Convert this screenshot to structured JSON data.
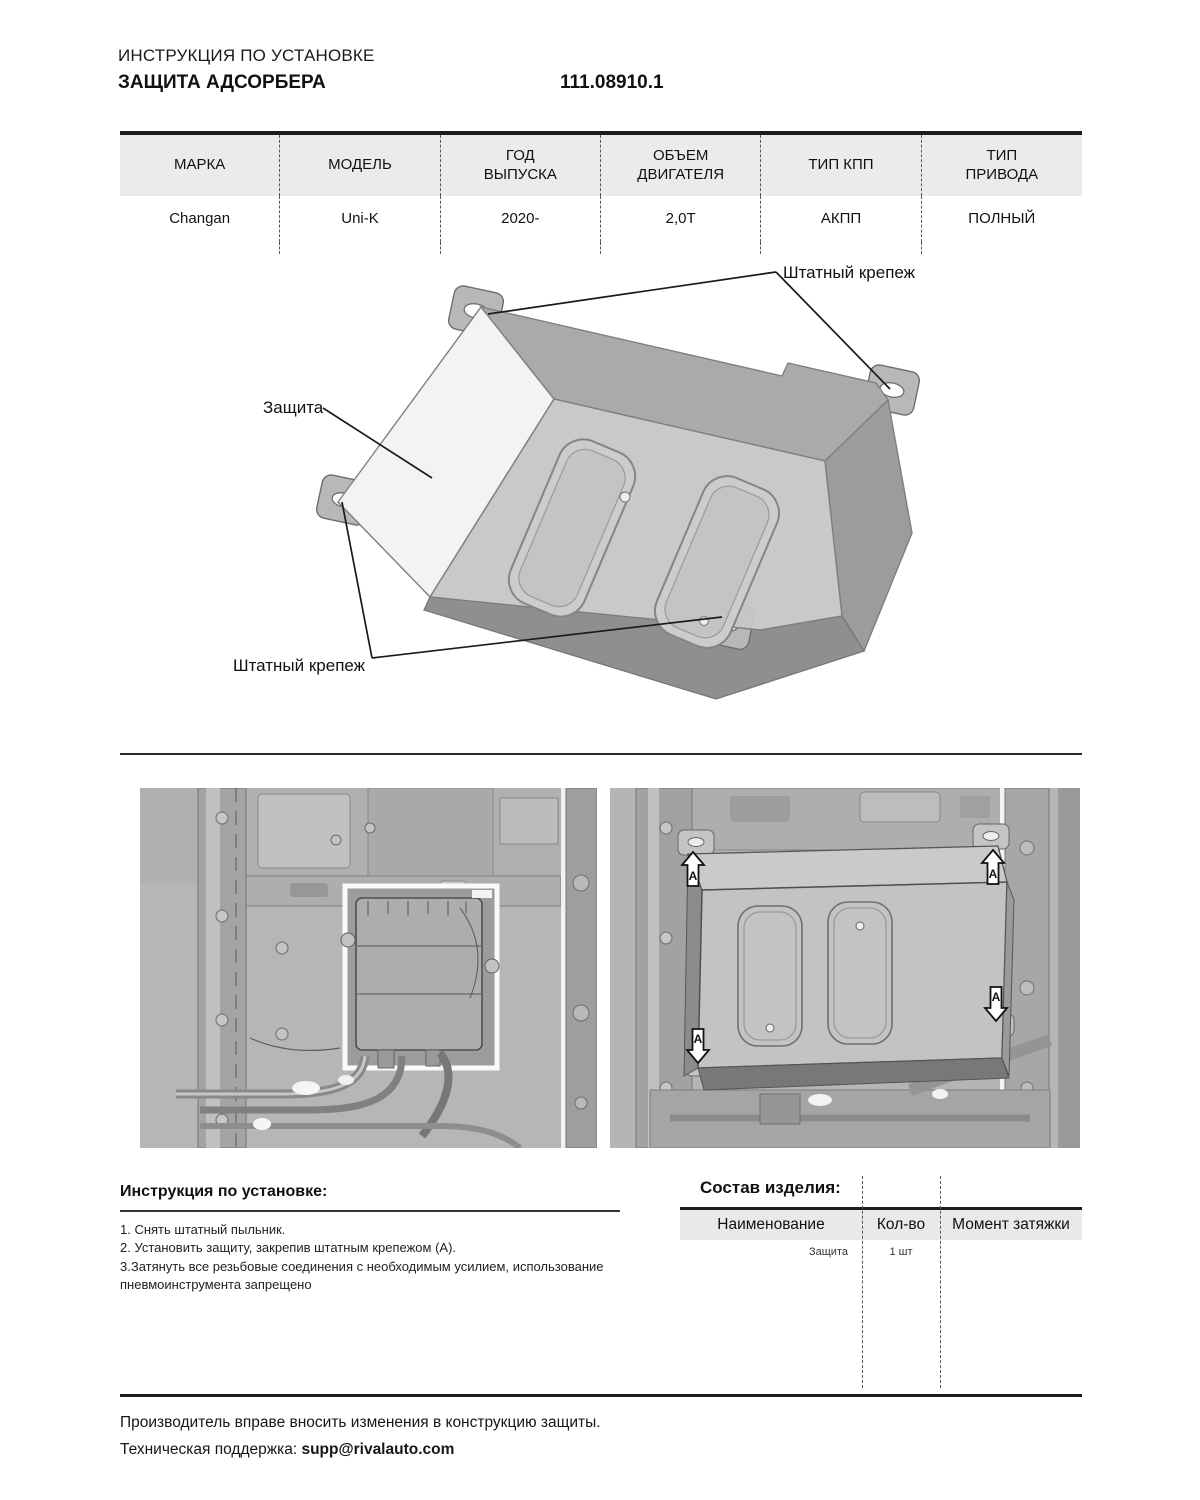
{
  "header": {
    "doc_type": "ИНСТРУКЦИЯ ПО УСТАНОВКЕ",
    "title": "ЗАЩИТА АДСОРБЕРА",
    "part_number": "111.08910.1"
  },
  "spec_table": {
    "columns": [
      "МАРКА",
      "МОДЕЛЬ",
      "ГОД ВЫПУСКА",
      "ОБЪЕМ ДВИГАТЕЛЯ",
      "ТИП КПП",
      "ТИП ПРИВОДА"
    ],
    "row": [
      "Changan",
      "Uni-K",
      "2020-",
      "2,0T",
      "АКПП",
      "ПОЛНЫЙ"
    ]
  },
  "diagram": {
    "label_fastener_top": "Штатный крепеж",
    "label_guard": "Защита",
    "label_fastener_bottom": "Штатный крепеж"
  },
  "photos": {
    "arrow_letter": "A"
  },
  "instructions": {
    "title": "Инструкция по установке:",
    "steps": [
      "1. Снять штатный пыльник.",
      "2. Установить защиту, закрепив штатным крепежом (А).",
      "3.Затянуть все резьбовые соединения с необходимым усилием, использование пневмоинструмента запрещено"
    ]
  },
  "composition": {
    "title": "Состав изделия:",
    "columns": [
      "Наименование",
      "Кол-во",
      "Момент затяжки"
    ],
    "rows": [
      [
        "Защита",
        "1 шт",
        ""
      ]
    ]
  },
  "footer": {
    "line1": "Производитель вправе вносить изменения в конструкцию защиты.",
    "support_label": "Техническая поддержка: ",
    "support_email": "supp@rivalauto.com"
  },
  "colors": {
    "rule": "#1c1c1c",
    "table_header_bg": "#ebebeb",
    "dashed_line": "#575757",
    "photo_base": "#b5b5b5"
  }
}
